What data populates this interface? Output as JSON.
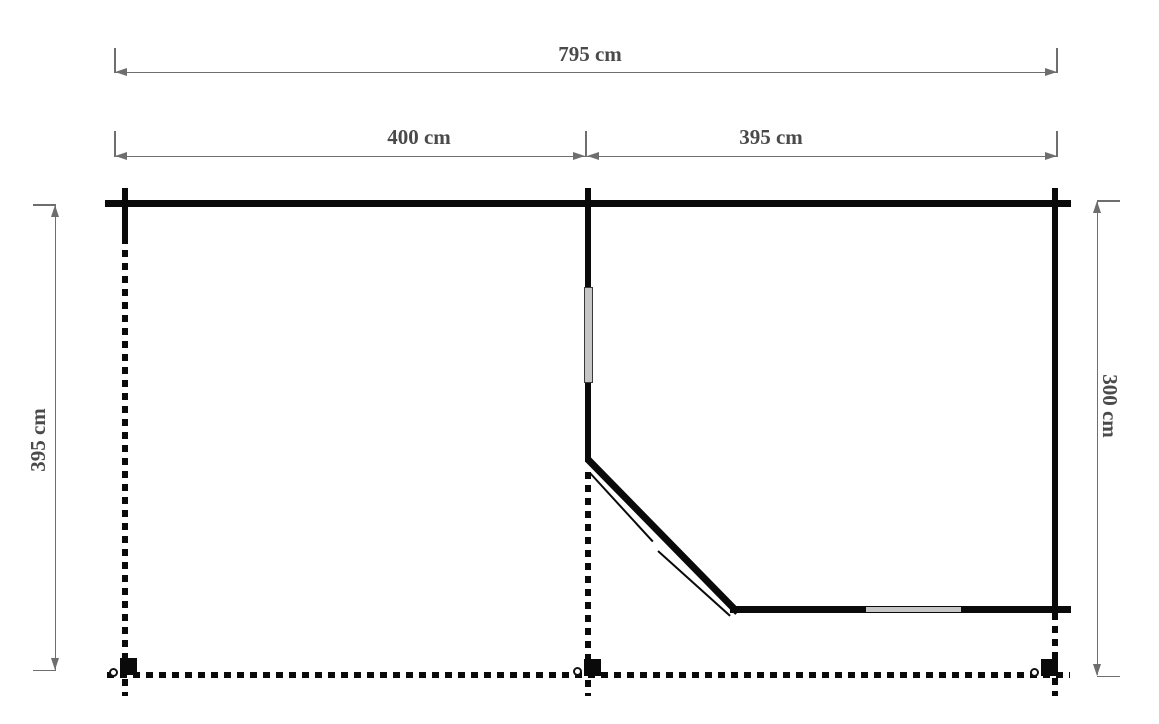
{
  "diagram": {
    "type": "floor-plan",
    "dimensions": {
      "total_width": "795 cm",
      "section_left_width": "400 cm",
      "section_right_width": "395 cm",
      "depth_left": "395 cm",
      "depth_right": "300 cm"
    },
    "colors": {
      "background": "#ffffff",
      "wall": "#0a0a0a",
      "window_fill": "#c6c6c6",
      "dimension_line": "#6e6e6e",
      "dimension_text": "#4a4a4a"
    },
    "elements": {
      "windows": 2,
      "posts": 3
    }
  }
}
